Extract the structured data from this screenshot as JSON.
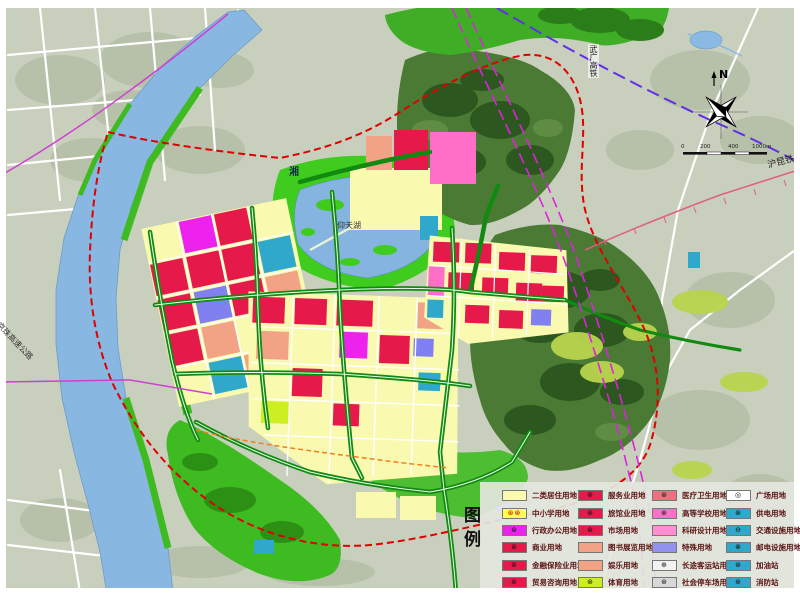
{
  "map": {
    "labels": {
      "river": "湘",
      "lake": "仰天湖",
      "high_speed_rail": "武广高铁",
      "expressway": "京珠高速公路",
      "railway": "沪昆铁路"
    },
    "compass": {
      "north": "N"
    },
    "scale": {
      "ticks": [
        "0",
        "200",
        "400",
        "1000m"
      ]
    }
  },
  "legend": {
    "title": "图例",
    "columns": [
      {
        "items": [
          {
            "label": "二类居住用地",
            "color": "#FAFAB0",
            "symbol": ""
          },
          {
            "label": "中小学用地",
            "color": "#FFFF55",
            "symbol": "⊛⊛"
          },
          {
            "label": "行政办公用地",
            "color": "#EE22EE",
            "symbol": "⊛"
          },
          {
            "label": "商业用地",
            "color": "#E6194B",
            "symbol": "⊛"
          },
          {
            "label": "金融保险业用地",
            "color": "#E6194B",
            "symbol": "⊛"
          },
          {
            "label": "贸易咨询用地",
            "color": "#E6194B",
            "symbol": "⊛"
          }
        ]
      },
      {
        "items": [
          {
            "label": "服务业用地",
            "color": "#E6194B",
            "symbol": "⊛"
          },
          {
            "label": "旅馆业用地",
            "color": "#E6194B",
            "symbol": "⊛"
          },
          {
            "label": "市场用地",
            "color": "#E6194B",
            "symbol": "⊛"
          },
          {
            "label": "图书展览用地",
            "color": "#F2A285",
            "symbol": ""
          },
          {
            "label": "娱乐用地",
            "color": "#F2A285",
            "symbol": ""
          },
          {
            "label": "体育用地",
            "color": "#CCEE22",
            "symbol": "⊛"
          }
        ]
      },
      {
        "items": [
          {
            "label": "医疗卫生用地",
            "color": "#F06E7E",
            "symbol": "⊛"
          },
          {
            "label": "高等学校用地",
            "color": "#FF6EC7",
            "symbol": "⊛"
          },
          {
            "label": "科研设计用地",
            "color": "#FF8FD2",
            "symbol": ""
          },
          {
            "label": "特殊用地",
            "color": "#9191F0",
            "symbol": ""
          },
          {
            "label": "长途客运站用地",
            "color": "#F2F2F2",
            "symbol": "⊕"
          },
          {
            "label": "社会停车场用地",
            "color": "#D8D8D8",
            "symbol": "⊛"
          }
        ]
      },
      {
        "items": [
          {
            "label": "广场用地",
            "color": "#FFFFFF",
            "symbol": "◎"
          },
          {
            "label": "供电用地",
            "color": "#2FA8CC",
            "symbol": "⊛"
          },
          {
            "label": "交通设施用地",
            "color": "#2FA8CC",
            "symbol": "⊖"
          },
          {
            "label": "邮电设施用地",
            "color": "#2FA8CC",
            "symbol": "⊗"
          },
          {
            "label": "加油站",
            "color": "#2FA8CC",
            "symbol": "⊛"
          },
          {
            "label": "消防站",
            "color": "#2FA8CC",
            "symbol": "⊛"
          }
        ]
      }
    ]
  }
}
